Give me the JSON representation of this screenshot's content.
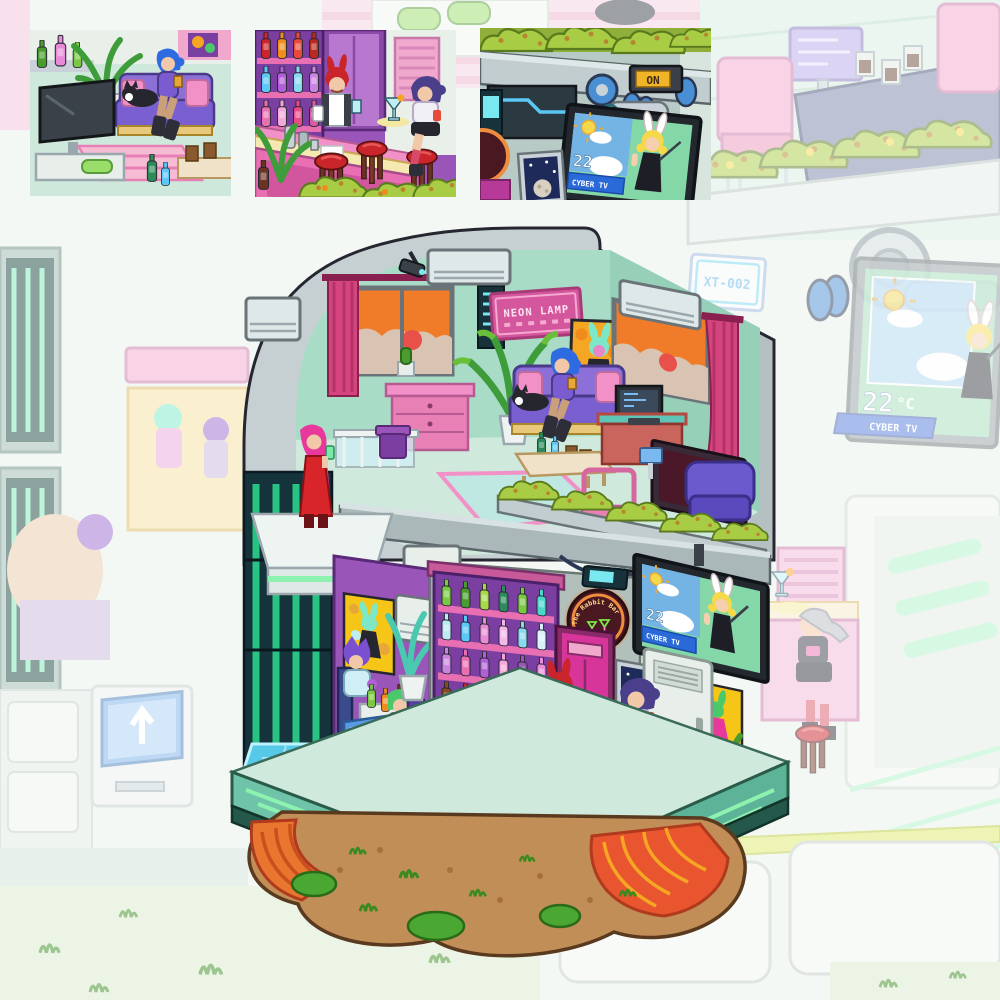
{
  "scene": {
    "description": "Isometric pixel-art cyberpunk bar building floating on a rock island, washed-out city background, three close-up detail insets at top",
    "signs": {
      "neon_lamp": "NEON LAMP",
      "rabbit_bar_sign": "The Rabbit Bar",
      "on_label": "ON",
      "unit_tag": "XT-002"
    },
    "weather_tv": {
      "temperature": "22",
      "degree_unit": "°C",
      "channel": "CYBER TV"
    },
    "billboard": {
      "temperature": "22",
      "degree_unit": "°C",
      "channel": "CYBER TV"
    },
    "colors": {
      "outline": "#262630",
      "shell_gray": "#c6d0d2",
      "teal_wall": "#a9dcc6",
      "wall_purple": "#9a55b8",
      "bar_pink": "#e873b2",
      "neon_pink": "#ff8fd0",
      "curtain_pink": "#d6447e",
      "sunset_orange": "#f07c2a",
      "hedge_green": "#a9cc45",
      "glow_green": "#8df2b0",
      "pipe_blue": "#4a8fd4",
      "screen_green": "#84d8a8",
      "sky_blue": "#74b4e4",
      "tag_blue": "#2a6ad8",
      "rock_orange": "#e8762e",
      "dirt_brown": "#c28e58",
      "base_teal": "#6fc3a8"
    }
  }
}
